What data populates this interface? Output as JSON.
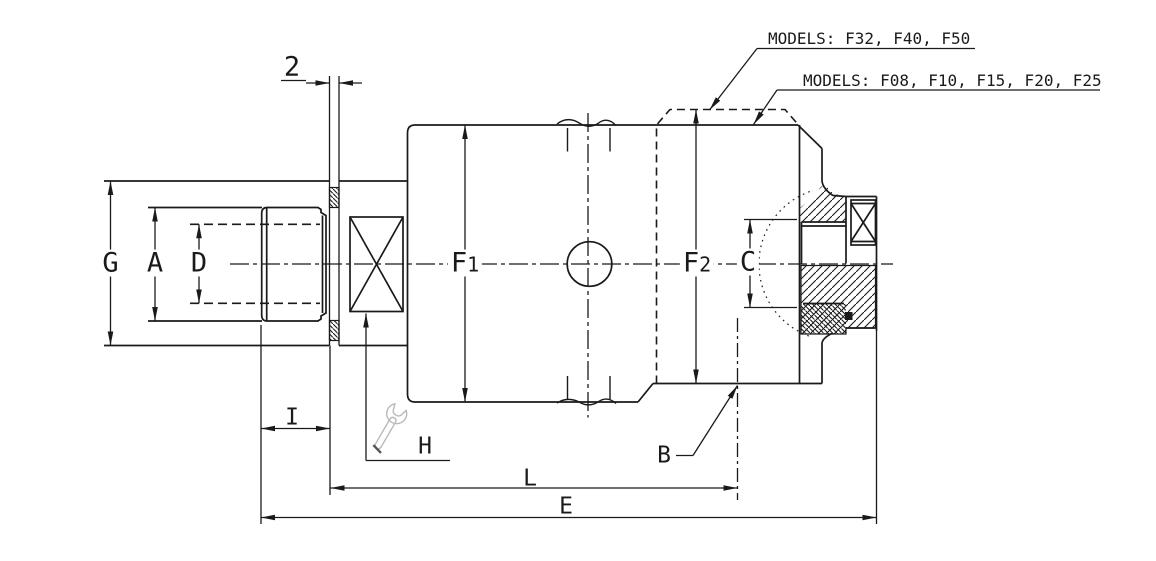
{
  "drawing": {
    "background": "#ffffff",
    "line_color": "#1a1a1a",
    "wrench_color": "#b9b9b9",
    "callouts": {
      "large_models": "MODELS: F32, F40, F50",
      "small_models": "MODELS: F08, F10, F15, F20, F25"
    },
    "dimensions": {
      "g": "G",
      "a": "A",
      "d": "D",
      "f1": {
        "main": "F",
        "sub": "1"
      },
      "f2": {
        "main": "F",
        "sub": "2"
      },
      "c": "C",
      "seal_width": "2",
      "i": "I",
      "h": "H",
      "l": "L",
      "e": "E",
      "b": "B"
    }
  }
}
